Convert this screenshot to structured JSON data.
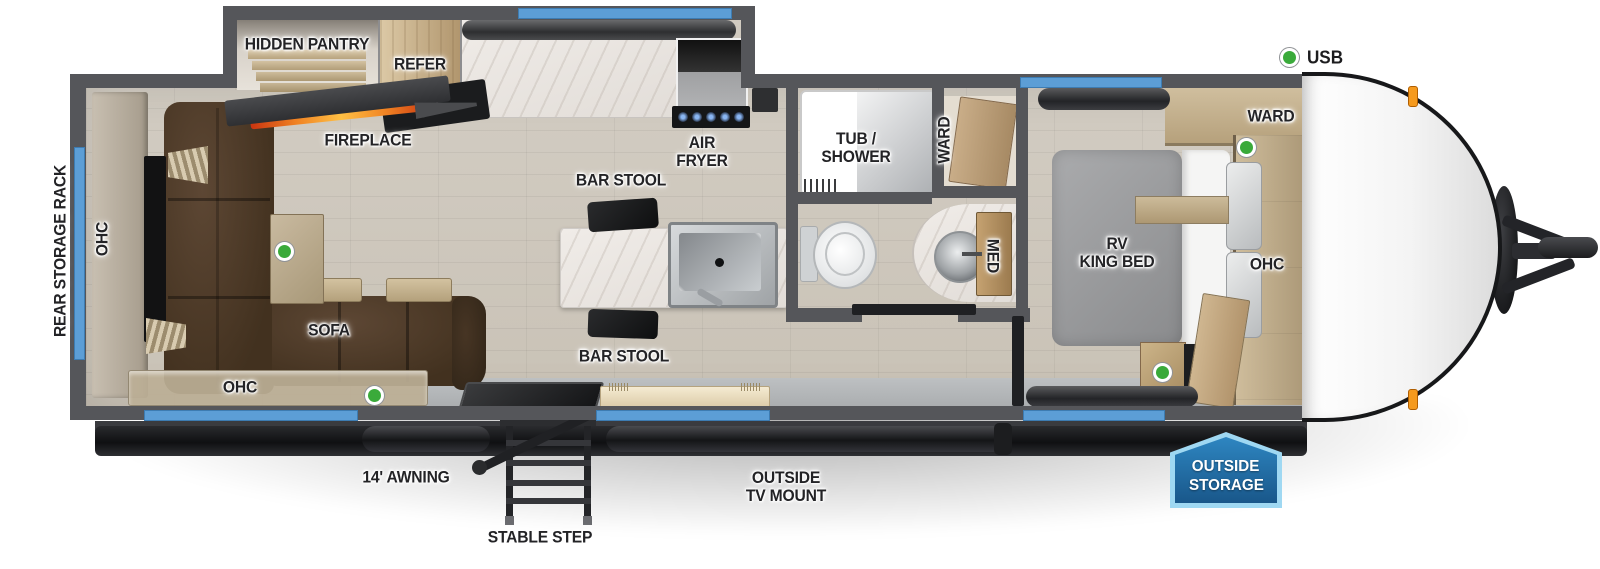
{
  "colors": {
    "wall_gray": "#55565a",
    "window_blue": "#5c9ed6",
    "usb_green": "#3aaa3a",
    "floor_wood": "#cdc6bb",
    "sofa_brown": "#4a372a",
    "cabinet_tan": "#c7b28c",
    "marble_white": "#ece8e3",
    "flame_orange": "#f08223",
    "badge_border": "#9fd8f2",
    "badge_blue_top": "#2e86c1",
    "badge_blue_bottom": "#19578a",
    "label_dark": "#232326"
  },
  "legend": {
    "usb_label": "USB"
  },
  "exterior": {
    "rear_storage_rack": "REAR STORAGE RACK",
    "awning": "14' AWNING",
    "stable_step": "STABLE STEP",
    "outside_tv_mount": [
      "OUTSIDE",
      "TV MOUNT"
    ],
    "outside_storage": [
      "OUTSIDE",
      "STORAGE"
    ]
  },
  "living": {
    "ohc_rear": "OHC",
    "ohc_front": "OHC",
    "sofa": "SOFA",
    "fireplace": "FIREPLACE"
  },
  "kitchen": {
    "hidden_pantry": "HIDDEN PANTRY",
    "refer": "REFER",
    "air_fryer": [
      "AIR",
      "FRYER"
    ],
    "bar_stool_top": "BAR STOOL",
    "bar_stool_bottom": "BAR STOOL"
  },
  "bathroom": {
    "tub_shower": [
      "TUB /",
      "SHOWER"
    ],
    "ward": "WARD",
    "med": "MED"
  },
  "bedroom": {
    "bed": [
      "RV",
      "KING BED"
    ],
    "ward": "WARD",
    "ohc": "OHC"
  }
}
